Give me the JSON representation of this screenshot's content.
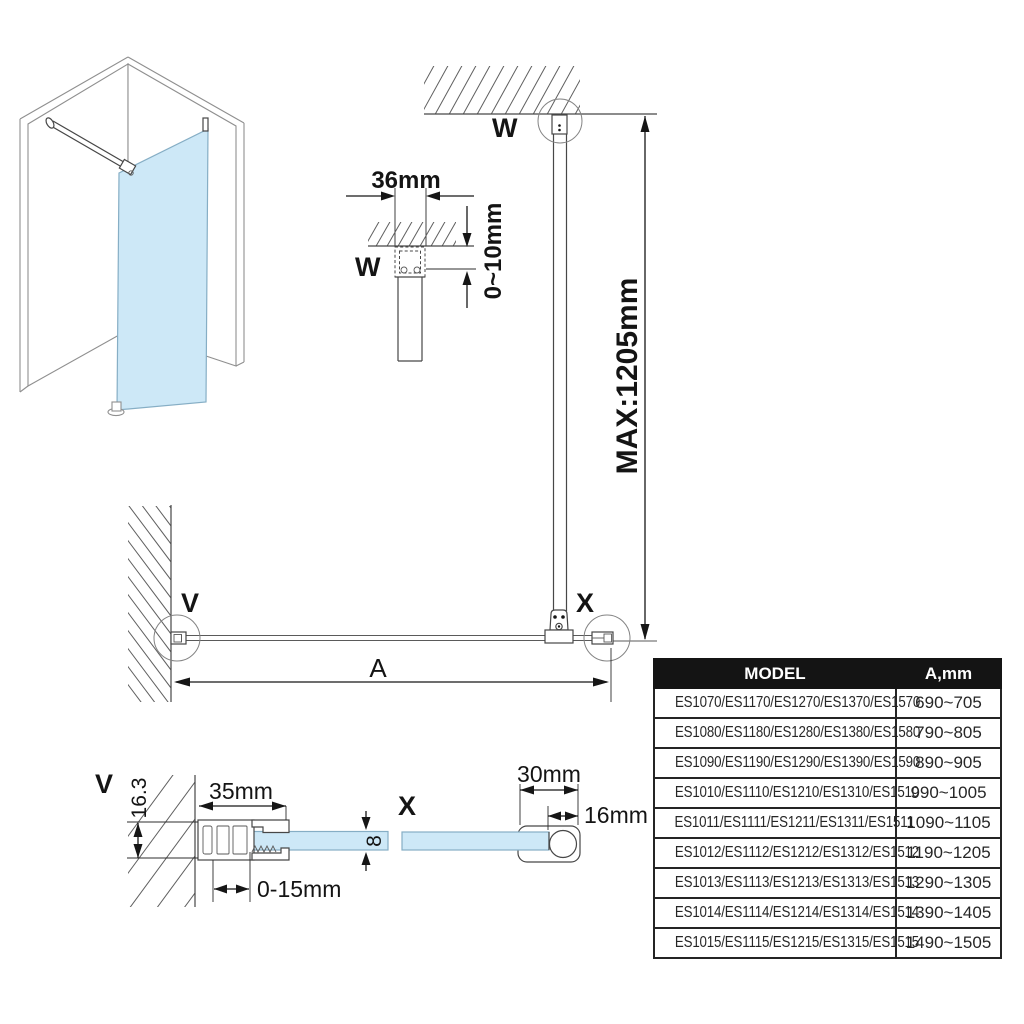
{
  "drawing": {
    "plan_view": {
      "label_w": "W",
      "label_v": "V",
      "label_x": "X",
      "dim_a": "A",
      "dim_max": "MAX:1205mm"
    },
    "detail_w": {
      "label": "W",
      "dim_width": "36mm",
      "dim_gap": "0~10mm"
    },
    "detail_v": {
      "label": "V",
      "dim_width": "35mm",
      "dim_height": "16.3",
      "dim_glass_thickness": "8",
      "dim_adjust": "0-15mm"
    },
    "detail_x": {
      "label": "X",
      "dim_width": "30mm",
      "dim_depth": "16mm"
    }
  },
  "table": {
    "headers": [
      "MODEL",
      "A,mm"
    ],
    "rows": [
      {
        "model": "ES1070/ES1170/ES1270/ES1370/ES1570",
        "a_mm": "690~705"
      },
      {
        "model": "ES1080/ES1180/ES1280/ES1380/ES1580",
        "a_mm": "790~805"
      },
      {
        "model": "ES1090/ES1190/ES1290/ES1390/ES1590",
        "a_mm": "890~905"
      },
      {
        "model": "ES1010/ES1110/ES1210/ES1310/ES1510",
        "a_mm": "990~1005"
      },
      {
        "model": "ES1011/ES1111/ES1211/ES1311/ES1511",
        "a_mm": "1090~1105"
      },
      {
        "model": "ES1012/ES1112/ES1212/ES1312/ES1512",
        "a_mm": "1190~1205"
      },
      {
        "model": "ES1013/ES1113/ES1213/ES1313/ES1513",
        "a_mm": "1290~1305"
      },
      {
        "model": "ES1014/ES1114/ES1214/ES1314/ES1514",
        "a_mm": "1390~1405"
      },
      {
        "model": "ES1015/ES1115/ES1215/ES1315/ES1515",
        "a_mm": "1490~1505"
      }
    ]
  },
  "colors": {
    "glass": "#cde8f7",
    "line": "#474747",
    "header_bg": "#141414",
    "header_text": "#ffffff"
  }
}
